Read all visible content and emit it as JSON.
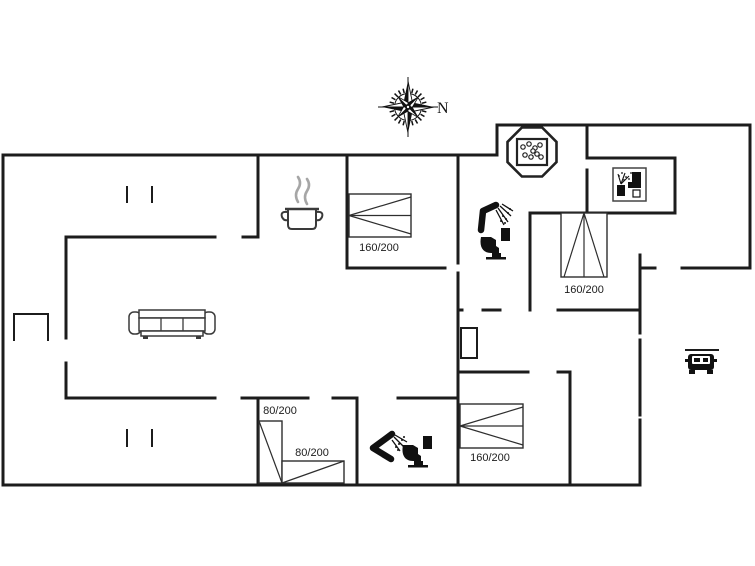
{
  "canvas": {
    "width": 755,
    "height": 566,
    "background": "#ffffff",
    "wall_color": "#1c1c1c",
    "furniture_stroke": "#333333",
    "black_fill": "#111111",
    "steam_color": "#a6a6a6",
    "label_color": "#1c1c1c"
  },
  "compass": {
    "label": "N",
    "x": 408,
    "y": 107
  },
  "floorplan": {
    "walls": [
      [
        3,
        155,
        497,
        155
      ],
      [
        497,
        125,
        497,
        155
      ],
      [
        497,
        125,
        750,
        125
      ],
      [
        750,
        125,
        750,
        268
      ],
      [
        3,
        155,
        3,
        485
      ],
      [
        3,
        485,
        640,
        485
      ],
      [
        66,
        237,
        215,
        237
      ],
      [
        243,
        237,
        258,
        237
      ],
      [
        66,
        237,
        66,
        338
      ],
      [
        66,
        363,
        66,
        398
      ],
      [
        66,
        398,
        215,
        398
      ],
      [
        242,
        398,
        308,
        398
      ],
      [
        333,
        398,
        357,
        398
      ],
      [
        398,
        398,
        458,
        398
      ],
      [
        258,
        155,
        258,
        236
      ],
      [
        258,
        398,
        258,
        485
      ],
      [
        347,
        155,
        347,
        268
      ],
      [
        347,
        268,
        445,
        268
      ],
      [
        458,
        155,
        458,
        263
      ],
      [
        458,
        273,
        458,
        485
      ],
      [
        587,
        125,
        587,
        155
      ],
      [
        587,
        170,
        587,
        213
      ],
      [
        587,
        158,
        675,
        158
      ],
      [
        675,
        158,
        675,
        213
      ],
      [
        530,
        213,
        675,
        213
      ],
      [
        530,
        213,
        530,
        310
      ],
      [
        458,
        310,
        462,
        310
      ],
      [
        483,
        310,
        500,
        310
      ],
      [
        558,
        310,
        640,
        310
      ],
      [
        640,
        255,
        640,
        333
      ],
      [
        640,
        340,
        640,
        415
      ],
      [
        640,
        420,
        640,
        485
      ],
      [
        640,
        268,
        655,
        268
      ],
      [
        682,
        268,
        750,
        268
      ],
      [
        460,
        372,
        528,
        372
      ],
      [
        558,
        372,
        570,
        372
      ],
      [
        570,
        372,
        570,
        485
      ],
      [
        357,
        398,
        357,
        485
      ]
    ],
    "thin_lines": [
      [
        127,
        187,
        127,
        202
      ],
      [
        152,
        187,
        152,
        202
      ],
      [
        127,
        430,
        127,
        446
      ],
      [
        152,
        430,
        152,
        446
      ],
      [
        14,
        314,
        48,
        314
      ],
      [
        14,
        314,
        14,
        340
      ],
      [
        48,
        314,
        48,
        340
      ],
      [
        686,
        350,
        718,
        350
      ]
    ],
    "fireplace": {
      "x": 461,
      "y": 328,
      "w": 16,
      "h": 30
    },
    "beds": [
      {
        "name": "double-bed-top",
        "size_label": "160/200",
        "x": 349,
        "y": 194,
        "w": 62,
        "h": 43,
        "type": "double",
        "apex": "left",
        "lx": 379,
        "ly": 251
      },
      {
        "name": "double-bed-right",
        "size_label": "160/200",
        "x": 561,
        "y": 213,
        "w": 46,
        "h": 64,
        "type": "double",
        "apex": "top",
        "lx": 584,
        "ly": 293
      },
      {
        "name": "double-bed-south",
        "size_label": "160/200",
        "x": 460,
        "y": 404,
        "w": 63,
        "h": 44,
        "type": "double",
        "apex": "left",
        "lx": 490,
        "ly": 461
      },
      {
        "name": "single-bed-left",
        "size_label": "80/200",
        "x": 259,
        "y": 421,
        "w": 23,
        "h": 62,
        "type": "single",
        "diag": "tlbr",
        "lx": 280,
        "ly": 414
      },
      {
        "name": "single-bed-bottom",
        "size_label": "80/200",
        "x": 282,
        "y": 461,
        "w": 62,
        "h": 22,
        "type": "single",
        "diag": "bltr",
        "lx": 312,
        "ly": 456
      }
    ],
    "furniture": [
      {
        "name": "compass-icon",
        "type": "compass",
        "x": 408,
        "y": 107
      },
      {
        "name": "cooking-pot-icon",
        "type": "pot",
        "x": 302,
        "y": 222
      },
      {
        "name": "sofa-icon",
        "type": "sofa",
        "x": 129,
        "y": 307
      },
      {
        "name": "shower-icon",
        "type": "shower_a",
        "x": 490,
        "y": 213
      },
      {
        "name": "toilet-icon",
        "type": "toilet",
        "x": 494,
        "y": 243
      },
      {
        "name": "hot-tub-icon",
        "type": "hottub",
        "x": 532,
        "y": 152
      },
      {
        "name": "dishwasher-icon",
        "type": "dishwasher",
        "x": 613,
        "y": 168
      },
      {
        "name": "car-icon",
        "type": "car",
        "x": 701,
        "y": 363
      },
      {
        "name": "shower-icon",
        "type": "shower_b",
        "x": 383,
        "y": 449
      },
      {
        "name": "toilet-icon",
        "type": "toilet",
        "x": 416,
        "y": 451
      }
    ]
  }
}
